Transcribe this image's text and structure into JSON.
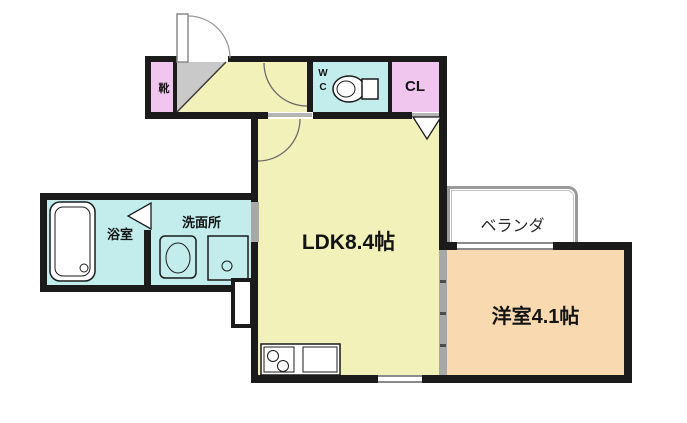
{
  "colors": {
    "wall": "#1b1b1b",
    "ldk_yellow": "#f3f1ba",
    "wet_cyan": "#c3eded",
    "closet_pink": "#f0c6ee",
    "room_orange": "#f8d9b0",
    "genkan_gray": "#c9c9c9",
    "slide_gray": "#a8a8a8",
    "veranda_border": "#9a9a9a"
  },
  "rooms": {
    "ldk": {
      "label": "LDK8.4帖",
      "size_jo": 8.4
    },
    "western": {
      "label": "洋室4.1帖",
      "size_jo": 4.1
    },
    "veranda": {
      "label": "ベランダ"
    },
    "washroom": {
      "label": "洗面所"
    },
    "bathroom": {
      "label": "浴室"
    },
    "wc": {
      "line1": "W",
      "line2": "C"
    },
    "closet": {
      "label": "CL"
    },
    "shoe_cabinet": {
      "label": "靴"
    }
  },
  "icons": {
    "entrance-door": "quarter-arc-swing",
    "hall-door": "quarter-arc-swing",
    "ldk-door": "quarter-arc-swing",
    "closet-bifold-door": "triangle",
    "bath-folding-door": "triangle",
    "bathtub": "rounded-rect-with-drain",
    "washing-machine": "rounded-rect-with-oval",
    "washroom-sink": "square-with-circle",
    "toilet": "bowl-with-tank",
    "kitchen-stove": "two-burner-circles",
    "kitchen-sink": "square",
    "window": "double-gray-line",
    "sliding-door": "gray-band-with-ticks"
  }
}
